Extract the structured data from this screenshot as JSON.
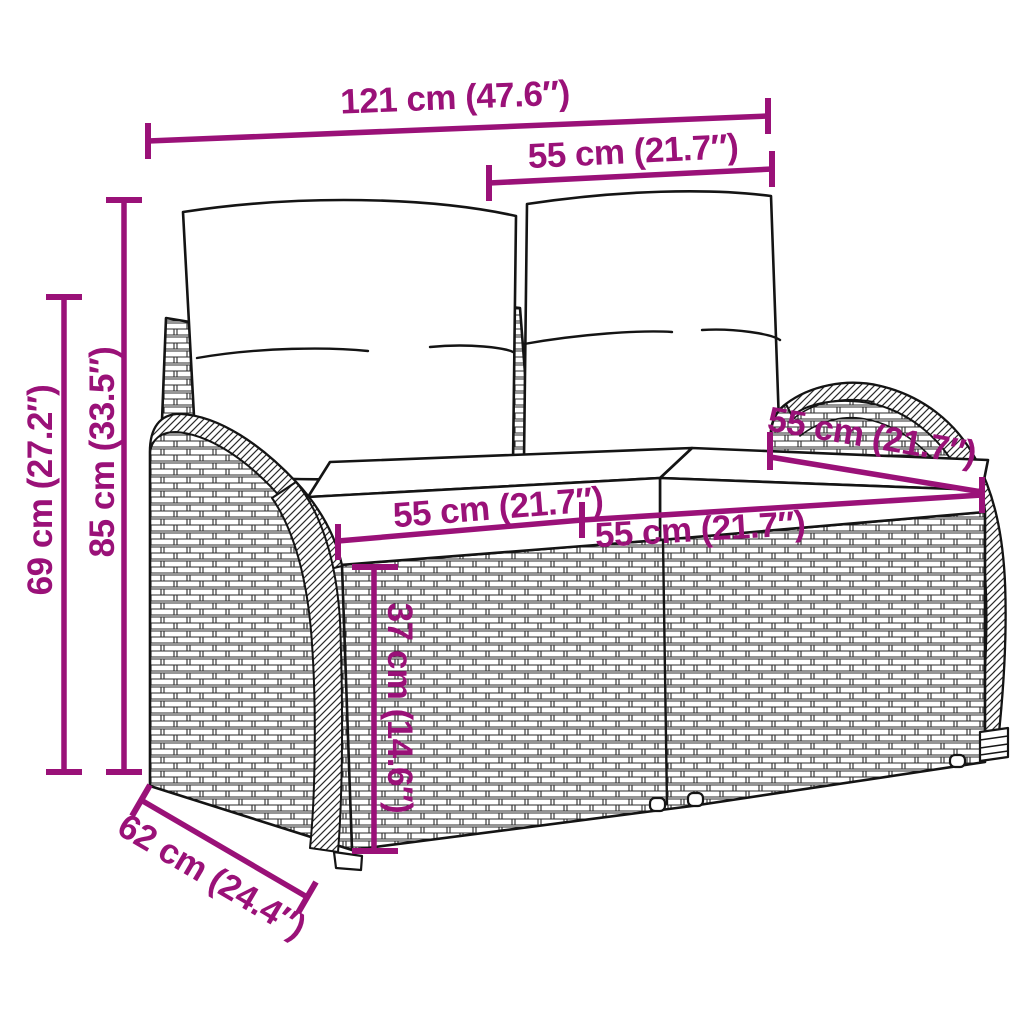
{
  "figure": {
    "type": "product-dimension-diagram",
    "subject_label": "rattan garden bench with back and seat cushions"
  },
  "colors": {
    "dimension_accent": "#9A1178",
    "line_art": "#141414",
    "background": "#FFFFFF"
  },
  "dimensions": {
    "overall_width": {
      "label": "121 cm (47.6″)",
      "cm": 121,
      "in": 47.6
    },
    "backrest_section_width": {
      "label": "55 cm (21.7″)",
      "cm": 55,
      "in": 21.7
    },
    "overall_height": {
      "label": "85 cm (33.5″)",
      "cm": 85,
      "in": 33.5
    },
    "backrest_height": {
      "label": "69 cm (27.2″)",
      "cm": 69,
      "in": 27.2
    },
    "seat_width_left": {
      "label": "55 cm (21.7″)",
      "cm": 55,
      "in": 21.7
    },
    "seat_width_right": {
      "label": "55 cm (21.7″)",
      "cm": 55,
      "in": 21.7
    },
    "seat_depth": {
      "label": "55 cm (21.7″)",
      "cm": 55,
      "in": 21.7
    },
    "seat_height": {
      "label": "37 cm (14.6″)",
      "cm": 37,
      "in": 14.6
    },
    "overall_depth": {
      "label": "62 cm (24.4″)",
      "cm": 62,
      "in": 24.4
    }
  }
}
